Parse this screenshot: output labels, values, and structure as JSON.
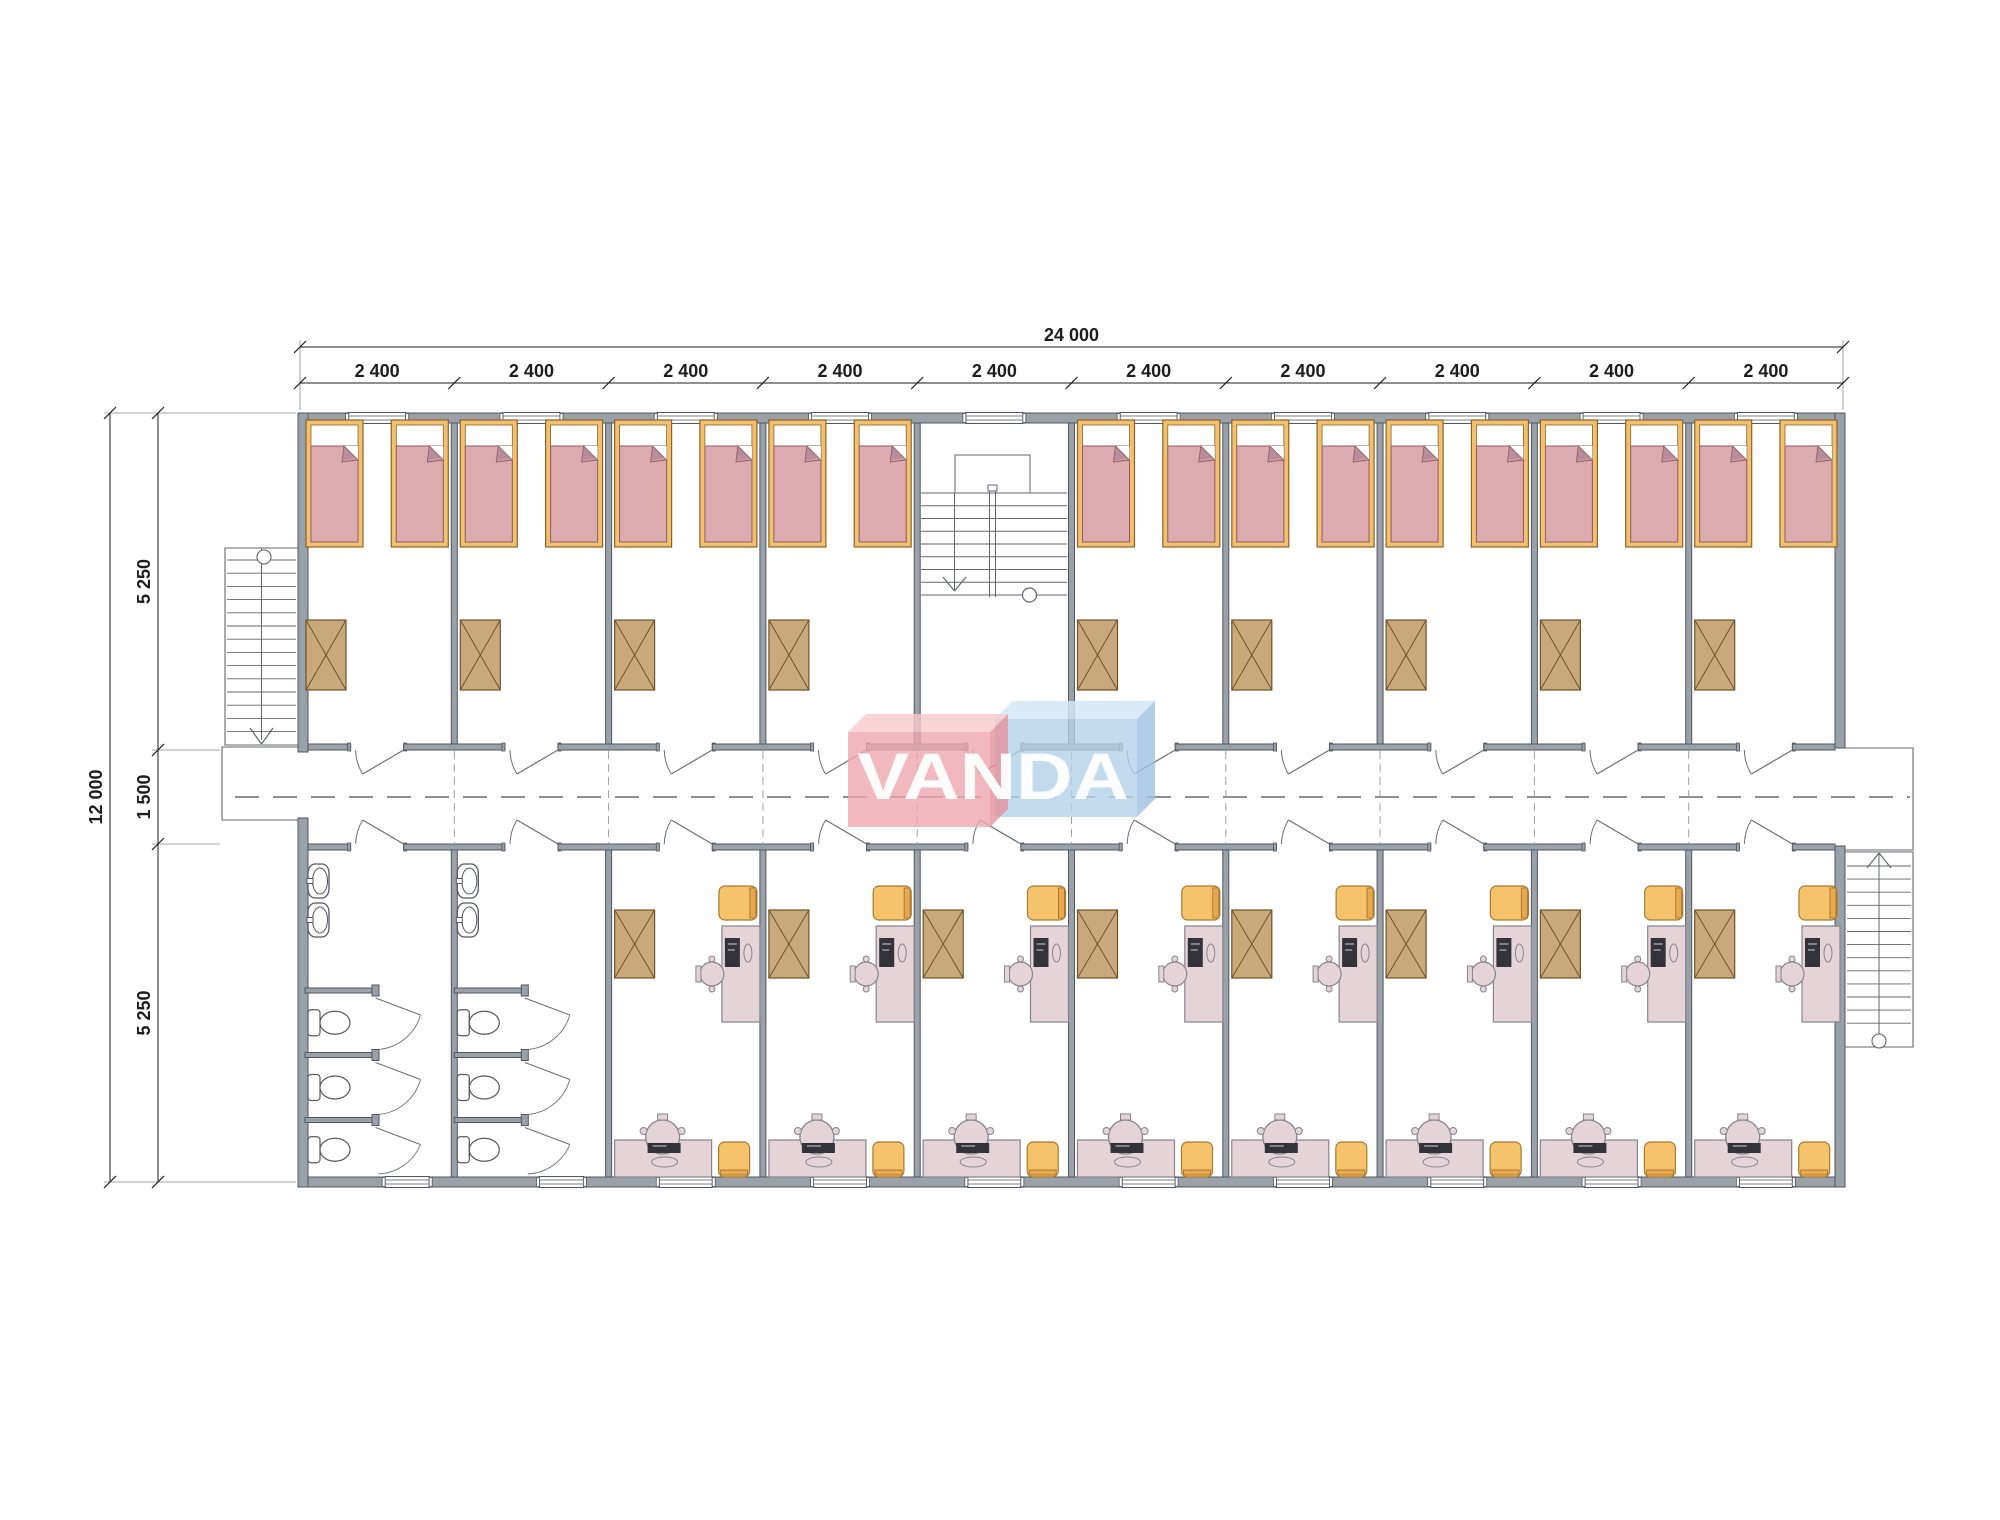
{
  "drawing": {
    "canvas": {
      "w": 2000,
      "h": 1520,
      "bg": "#ffffff"
    },
    "dimensions": {
      "color": "#1d1d1f",
      "font_px": 18,
      "top": {
        "total": "24 000",
        "segments": [
          "2 400",
          "2 400",
          "2 400",
          "2 400",
          "2 400",
          "2 400",
          "2 400",
          "2 400",
          "2 400",
          "2 400"
        ]
      },
      "left": {
        "total": "12 000",
        "segments": [
          "5 250",
          "1 500",
          "5 250"
        ]
      }
    },
    "logo": {
      "text_left": "VAN",
      "text_right": "DA",
      "full_text": "VANDA",
      "text_color": "rgba(255,255,255,0.95)",
      "pink_face": "rgba(238,168,175,0.80)",
      "pink_top": "rgba(247,201,205,0.80)",
      "pink_side": "rgba(226,146,156,0.80)",
      "blue_face": "rgba(178,209,233,0.80)",
      "blue_top": "rgba(211,230,246,0.84)",
      "blue_side": "rgba(157,194,224,0.80)"
    },
    "plan": {
      "x0": 300,
      "x1": 1843,
      "yTop": 413,
      "yCorrT": 750,
      "yCorrB": 844,
      "yBot": 1182,
      "extWall": 10,
      "intWall": 6,
      "corrWall": 6,
      "modules": 10,
      "door_width": 53,
      "window_top_w": 57,
      "window_bot_w": 53,
      "window_bath_w": 44,
      "top_row": [
        "bedroom",
        "bedroom",
        "bedroom",
        "bedroom",
        "stairwell",
        "bedroom",
        "bedroom",
        "bedroom",
        "bedroom",
        "bedroom"
      ],
      "bottom_row": [
        "bathroom",
        "bathroom",
        "study",
        "study",
        "study",
        "study",
        "study",
        "study",
        "study",
        "study"
      ],
      "beds_per_bedroom": 2,
      "toilets_per_bathroom": 3,
      "sinks_per_bathroom": 2,
      "colors": {
        "wall": "#9aa1a8",
        "wallEdge": "#53565e",
        "thin": "#6b6f76",
        "stair": "#63666d",
        "bedFrame": "#f2c06e",
        "bedFrameEdge": "#8a6426",
        "blanket": "#dcabb0",
        "blanketEdge": "#8f5f63",
        "fold": "#cf9aa2",
        "foldShadow": "#9b7d91",
        "table": "#c9a87c",
        "tableEdge": "#6f5327",
        "desk": "#e4d4d8",
        "deskEdge": "#85858d",
        "screen": "#33333a",
        "orange": "#f6c36d",
        "orangeEdge": "#a97a2e",
        "orangeBar": "#e6a94f",
        "fixture": "#55585f",
        "centerline": "#4a4a4a"
      }
    }
  }
}
